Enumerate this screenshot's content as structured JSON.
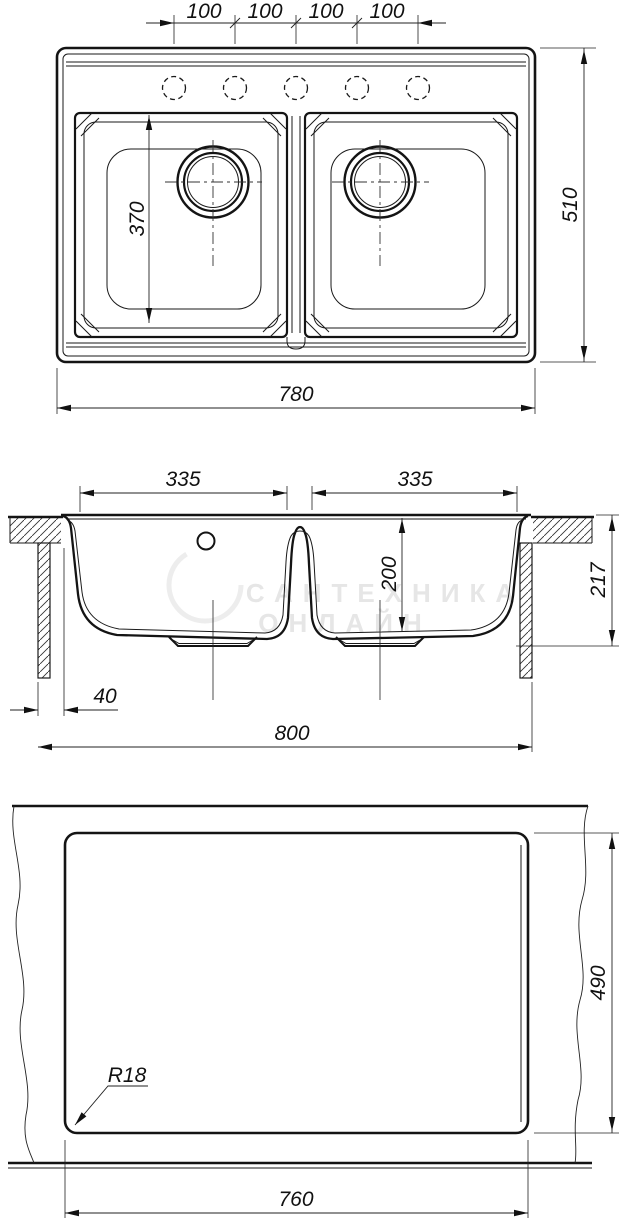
{
  "drawing": {
    "type": "technical-drawing",
    "subject": "double-bowl kitchen sink, three orthographic views with installation cutout",
    "watermark": {
      "line1": "САНТЕХНИКА",
      "line2": "ОНЛАЙН"
    },
    "dims": {
      "top": {
        "spacing": [
          "100",
          "100",
          "100",
          "100"
        ],
        "width": "780",
        "depth": "510",
        "bowl_length": "370"
      },
      "section": {
        "bowl_left": "335",
        "bowl_right": "335",
        "bowl_depth": "200",
        "overall_height": "217",
        "edge_offset": "40",
        "overall_width": "800"
      },
      "cutout": {
        "width": "760",
        "depth": "490",
        "radius": "R18"
      }
    }
  }
}
